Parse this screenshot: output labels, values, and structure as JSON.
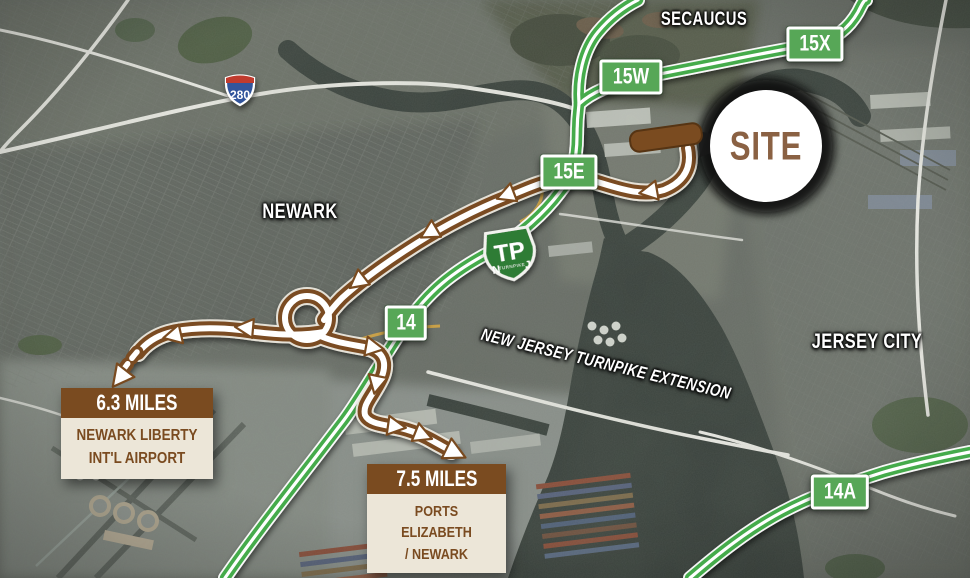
{
  "region_labels": {
    "secaucus": "SECAUCUS",
    "newark": "NEWARK",
    "jersey_city": "JERSEY CITY",
    "turnpike_extension": "NEW JERSEY TURNPIKE EXTENSION"
  },
  "exit_badges": [
    {
      "id": "15X",
      "label": "15X"
    },
    {
      "id": "15W",
      "label": "15W"
    },
    {
      "id": "15E",
      "label": "15E"
    },
    {
      "id": "14",
      "label": "14"
    },
    {
      "id": "14A",
      "label": "14A"
    }
  ],
  "site_marker": {
    "label": "SITE"
  },
  "shields": {
    "interstate": {
      "number": "280"
    },
    "turnpike": {
      "big": "TP",
      "left": "N",
      "right": "J",
      "banner": "TURNPIKE"
    }
  },
  "callouts": {
    "airport": {
      "distance": "6.3 MILES",
      "line1": "NEWARK LIBERTY",
      "line2": "INT'L AIRPORT"
    },
    "ports": {
      "distance": "7.5 MILES",
      "line1": "PORTS ELIZABETH",
      "line2": "/ NEWARK"
    }
  },
  "colors": {
    "route_green": "#44ab4b",
    "badge_green": "#57a757",
    "route_brown": "#7a4b20",
    "site_text_brown": "#8a6143",
    "callout_body_bg": "#ece6d8",
    "label_white": "#ffffff",
    "water": "#39413c"
  }
}
